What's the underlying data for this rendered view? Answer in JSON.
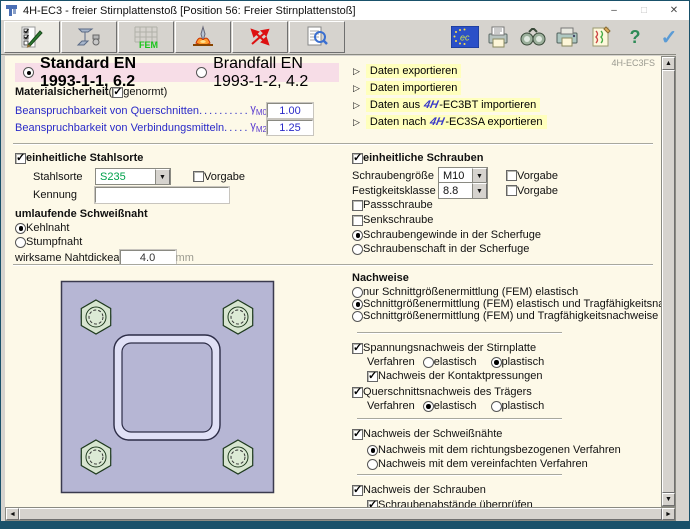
{
  "ui": {
    "dd_arrow": "▼",
    "link_arrow": "▷",
    "up": "▲",
    "down": "▼",
    "left": "◄",
    "right": "►"
  },
  "window": {
    "title": "4H-EC3 - freier Stirnplattenstoß [Position 56: Freier Stirnplattenstoß]",
    "minimize": "–",
    "maximize": "□",
    "close": "✕"
  },
  "toolbar": {
    "fem_label": "FEM",
    "help_glyph": "?",
    "ok_glyph": "✓"
  },
  "content": {
    "corner_label": "4H-EC3FS",
    "norm": {
      "options": [
        {
          "label": "Standard EN 1993-1-1, 6.2",
          "selected": true
        },
        {
          "label": "Brandfall EN 1993-1-2, 4.2",
          "selected": false
        }
      ]
    },
    "material": {
      "title": "Materialsicherheit",
      "open_paren": "(",
      "genormt_label": "genormt)",
      "genormt_checked": true,
      "rows": [
        {
          "label": "Beanspruchbarkeit von Querschnitten",
          "dots": "..............",
          "sym": "γ",
          "sub": "M0",
          "value": "1.00"
        },
        {
          "label": "Beanspruchbarkeit von Verbindungsmitteln",
          "dots": ".........",
          "sym": "γ",
          "sub": "M2",
          "value": "1.25"
        }
      ]
    },
    "links": [
      {
        "pre": "Daten exportieren",
        "logo": "",
        "post": ""
      },
      {
        "pre": "Daten importieren",
        "logo": "",
        "post": ""
      },
      {
        "pre": "Daten aus ",
        "logo": "4H",
        "post": "-EC3BT importieren"
      },
      {
        "pre": "Daten nach ",
        "logo": "4H",
        "post": "-EC3SA exportieren"
      }
    ],
    "stahl": {
      "title": "einheitliche Stahlsorte",
      "checked": true,
      "sorte_label": "Stahlsorte",
      "sorte_value": "S235",
      "vorgabe_label": "Vorgabe",
      "vorgabe_checked": false,
      "kennung_label": "Kennung",
      "kennung_value": ""
    },
    "schweissnaht": {
      "title": "umlaufende Schweißnaht",
      "options": [
        {
          "label": "Kehlnaht",
          "selected": true
        },
        {
          "label": "Stumpfnaht",
          "selected": false
        }
      ],
      "dicke_label": "wirksame Nahtdicke",
      "dicke_sym": "a",
      "dicke_value": "4.0",
      "dicke_unit": "mm"
    },
    "schrauben": {
      "title": "einheitliche Schrauben",
      "checked": true,
      "groesse_label": "Schraubengröße",
      "groesse_value": "M10",
      "vorgabe1_label": "Vorgabe",
      "vorgabe1_checked": false,
      "klasse_label": "Festigkeitsklasse",
      "klasse_value": "8.8",
      "vorgabe2_label": "Vorgabe",
      "vorgabe2_checked": false,
      "pass_label": "Passschraube",
      "pass_checked": false,
      "senk_label": "Senkschraube",
      "senk_checked": false,
      "scherfuge": [
        {
          "label": "Schraubengewinde in der Scherfuge",
          "selected": true
        },
        {
          "label": "Schraubenschaft in der Scherfuge",
          "selected": false
        }
      ]
    },
    "nachweise": {
      "title": "Nachweise",
      "fem_options": [
        {
          "label": "nur Schnittgrößenermittlung (FEM) elastisch",
          "selected": false
        },
        {
          "label": "Schnittgrößenermittlung (FEM) elastisch und Tragfähigkeitsnachweise",
          "selected": true
        },
        {
          "label": "Schnittgrößenermittlung (FEM) und Tragfähigkeitsnachweise plastisch",
          "selected": false
        }
      ],
      "stirnplatte": {
        "label": "Spannungsnachweis der Stirnplatte",
        "checked": true,
        "verfahren_label": "Verfahren",
        "elastisch": "elastisch",
        "plastisch": "plastisch",
        "verfahren_selected": "plastisch",
        "kontakt_label": "Nachweis der Kontaktpressungen",
        "kontakt_checked": true
      },
      "traeger": {
        "label": "Querschnittsnachweis des Trägers",
        "checked": true,
        "verfahren_label": "Verfahren",
        "elastisch": "elastisch",
        "plastisch": "plastisch",
        "verfahren_selected": "elastisch"
      },
      "schweissnaehte": {
        "label": "Nachweis der Schweißnähte",
        "checked": true,
        "options": [
          {
            "label": "Nachweis mit dem richtungsbezogenen Verfahren",
            "selected": true
          },
          {
            "label": "Nachweis mit dem vereinfachten Verfahren",
            "selected": false
          }
        ]
      },
      "schrauben": {
        "label": "Nachweis der Schrauben",
        "checked": true,
        "abstaende_label": "Schraubenabstände überprüfen",
        "abstaende_checked": true
      }
    }
  }
}
